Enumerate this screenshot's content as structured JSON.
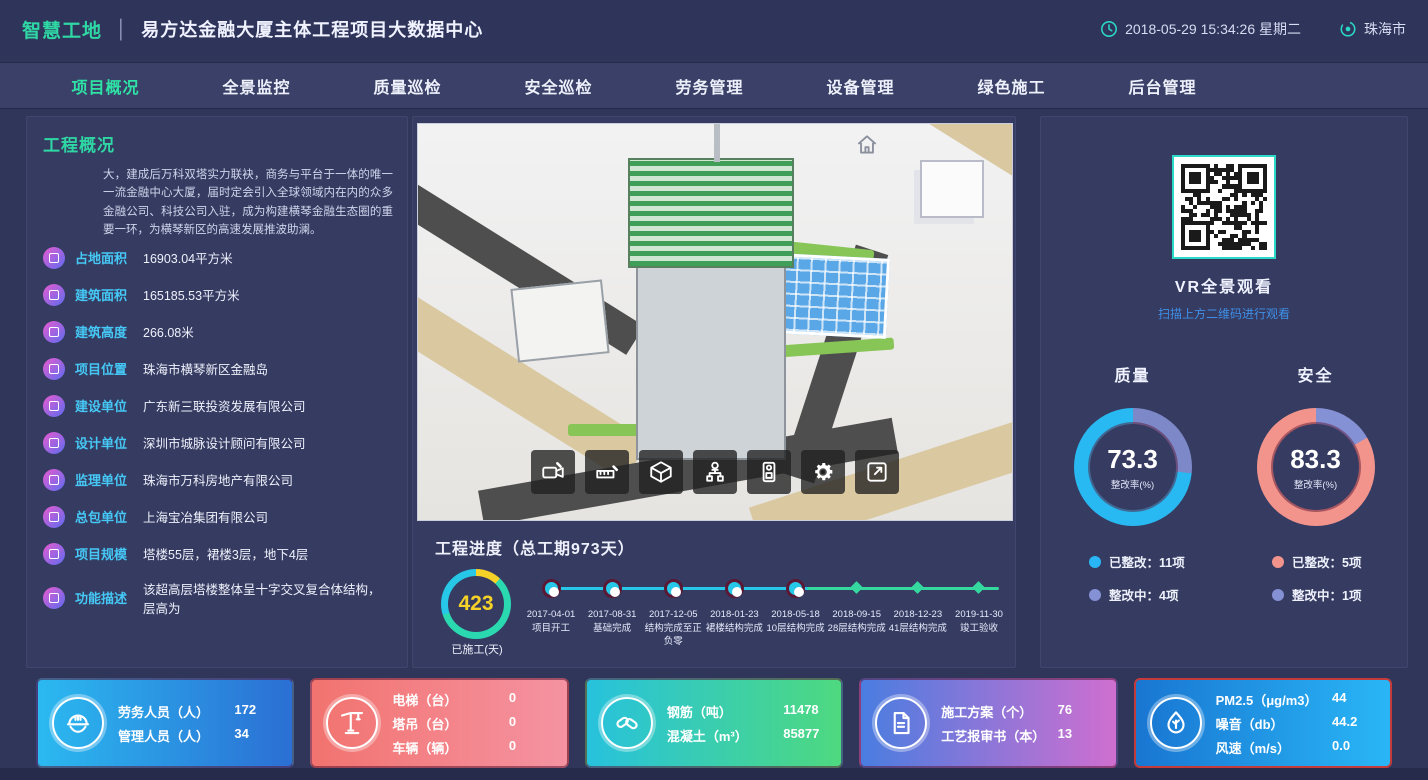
{
  "header": {
    "logo": "智慧工地",
    "divider": "│",
    "title": "易方达金融大厦主体工程项目大数据中心",
    "datetime": "2018-05-29 15:34:26 星期二",
    "city": "珠海市"
  },
  "nav": {
    "items": [
      {
        "label": "项目概况",
        "active": true
      },
      {
        "label": "全景监控",
        "active": false
      },
      {
        "label": "质量巡检",
        "active": false
      },
      {
        "label": "安全巡检",
        "active": false
      },
      {
        "label": "劳务管理",
        "active": false
      },
      {
        "label": "设备管理",
        "active": false
      },
      {
        "label": "绿色施工",
        "active": false
      },
      {
        "label": "后台管理",
        "active": false
      }
    ]
  },
  "overview": {
    "title": "工程概况",
    "description": "大，建成后万科双塔实力联袂，商务与平台于一体的唯一一流金融中心大厦，届时定会引入全球领域内在内的众多金融公司、科技公司入驻，成为构建横琴金融生态圈的重要一环，为横琴新区的高速发展推波助澜。",
    "items": [
      {
        "label": "占地面积",
        "value": "16903.04平方米"
      },
      {
        "label": "建筑面积",
        "value": "165185.53平方米"
      },
      {
        "label": "建筑高度",
        "value": "266.08米"
      },
      {
        "label": "项目位置",
        "value": "珠海市横琴新区金融岛"
      },
      {
        "label": "建设单位",
        "value": "广东新三联投资发展有限公司"
      },
      {
        "label": "设计单位",
        "value": "深圳市城脉设计顾问有限公司"
      },
      {
        "label": "监理单位",
        "value": "珠海市万科房地产有限公司"
      },
      {
        "label": "总包单位",
        "value": "上海宝冶集团有限公司"
      },
      {
        "label": "项目规模",
        "value": "塔楼55层，裙楼3层，地下4层"
      },
      {
        "label": "功能描述",
        "value": "该超高层塔楼整体呈十字交叉复合体结构，层高为"
      }
    ]
  },
  "viewport": {
    "toolbar_icons": [
      "video-camera",
      "measure",
      "cube",
      "org-chart",
      "device",
      "gear",
      "fullscreen"
    ]
  },
  "progress": {
    "title": "工程进度（总工期973天）",
    "days_done": "423",
    "days_label": "已施工(天)",
    "milestones": [
      {
        "date": "2017-04-01",
        "label": "项目开工",
        "done": true
      },
      {
        "date": "2017-08-31",
        "label": "基础完成",
        "done": true
      },
      {
        "date": "2017-12-05",
        "label": "结构完成至正负零",
        "done": true
      },
      {
        "date": "2018-01-23",
        "label": "裙楼结构完成",
        "done": true
      },
      {
        "date": "2018-05-18",
        "label": "10层结构完成",
        "done": true
      },
      {
        "date": "2018-09-15",
        "label": "28层结构完成",
        "done": false
      },
      {
        "date": "2018-12-23",
        "label": "41层结构完成",
        "done": false
      },
      {
        "date": "2019-11-30",
        "label": "竣工验收",
        "done": false
      }
    ]
  },
  "vr": {
    "title": "VR全景观看",
    "subtitle": "扫描上方二维码进行观看"
  },
  "gauges": [
    {
      "title": "质量",
      "value": 73.3,
      "display": "73.3",
      "sub": "整改率(%)",
      "color": "#29b9f2",
      "rest_color": "#7d88c9",
      "legend": [
        {
          "label": "已整改：11项",
          "color": "#29b6f6"
        },
        {
          "label": "整改中：4项",
          "color": "#8591d5"
        }
      ]
    },
    {
      "title": "安全",
      "value": 83.3,
      "display": "83.3",
      "sub": "整改率(%)",
      "color": "#f2948c",
      "rest_color": "#8591d5",
      "legend": [
        {
          "label": "已整改：5项",
          "color": "#f2948c"
        },
        {
          "label": "整改中：1项",
          "color": "#8591d5"
        }
      ]
    }
  ],
  "cards": [
    {
      "icon": "worker-helmet",
      "gradient": {
        "from": "#2bb9f0",
        "to": "#2b6fd4"
      },
      "rows": [
        {
          "label": "劳务人员（人）",
          "value": "172"
        },
        {
          "label": "管理人员（人）",
          "value": "34"
        }
      ]
    },
    {
      "icon": "tower-crane",
      "gradient": {
        "from": "#f2736f",
        "to": "#f593a2"
      },
      "rows": [
        {
          "label": "电梯（台）",
          "value": "0"
        },
        {
          "label": "塔吊（台）",
          "value": "0"
        },
        {
          "label": "车辆（辆）",
          "value": "0"
        }
      ]
    },
    {
      "icon": "rebar-links",
      "gradient": {
        "from": "#27c2dd",
        "to": "#4ed97f"
      },
      "rows": [
        {
          "label": "钢筋（吨）",
          "value": "11478"
        },
        {
          "label": "混凝土（m³）",
          "value": "85877"
        }
      ]
    },
    {
      "icon": "document",
      "gradient": {
        "from": "#4a7de0",
        "to": "#cf6fd0"
      },
      "rows": [
        {
          "label": "施工方案（个）",
          "value": "76"
        },
        {
          "label": "工艺报审书（本）",
          "value": "13"
        }
      ]
    },
    {
      "icon": "eco-drop",
      "gradient": {
        "from": "#1976d2",
        "to": "#29b6f6"
      },
      "border": "#c33b3b",
      "rows": [
        {
          "label": "PM2.5（μg/m3）",
          "value": "44"
        },
        {
          "label": "噪音（db）",
          "value": "44.2"
        },
        {
          "label": "风速（m/s）",
          "value": "0.0"
        }
      ]
    }
  ]
}
